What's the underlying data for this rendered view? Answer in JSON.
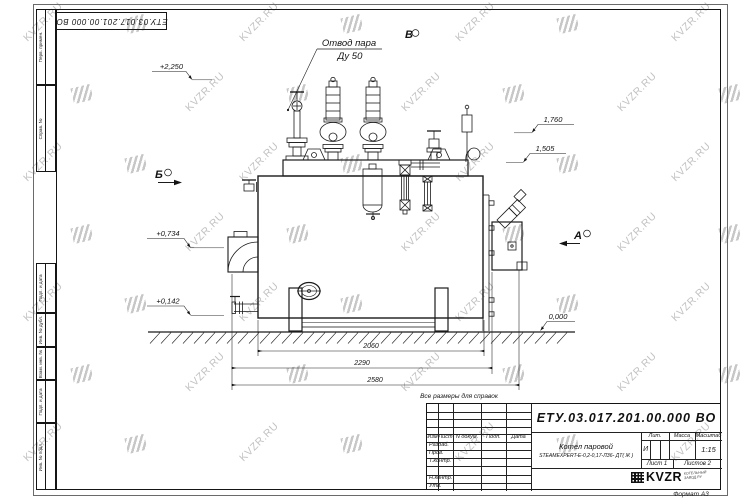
{
  "watermark": {
    "text": "KVZR.RU"
  },
  "corner_stamp": {
    "doc_number": "ЕТУ.03.017.201.00.000  ВО"
  },
  "margin": {
    "perv": "Перв. примен.",
    "sprav": "Справ. №",
    "podp1": "Подп. и дата",
    "inv_dubl": "Инв. № дубл.",
    "vzam": "Взам. инв. №",
    "podp2": "Подп. и дата",
    "inv_podl": "Инв. № подл."
  },
  "drawing": {
    "steam_outlet": {
      "line1": "Отвод пара",
      "line2": "Ду 50"
    },
    "views": {
      "top": "В",
      "right": "А",
      "left": "Б"
    },
    "elevations": {
      "e2250": "+2,250",
      "e1760": "1,760",
      "e1505": "1,505",
      "e0734": "+0,734",
      "e0142": "+0,142",
      "e0000": "0,000"
    },
    "dims": {
      "inner": "2060",
      "middle": "2290",
      "outer": "2580"
    },
    "note": "Все размеры для справок"
  },
  "title_block": {
    "doc_number": "ЕТУ.03.017.201.00.000  ВО",
    "name_line1": "Котел паровой",
    "name_line2": "STEAMEXPERT-E-0,2-0,17-ЛЗ6- ДТ( Ж )",
    "header_cols": {
      "izm": "Изм",
      "list": "Лист",
      "ndoc": "N докум.",
      "podp": "Подп.",
      "date": "Дата"
    },
    "rows": {
      "razrab": "Разраб.",
      "prov": "Пров.",
      "tkontr": "Т.контр.",
      "nkontr": "Н.контр.",
      "utv": "Утв."
    },
    "lit_label": "Лит.",
    "mass_label": "Масса",
    "scale_label": "Масштаб",
    "lit_value": "И",
    "scale_value": "1:15",
    "sheet": "Лист 1",
    "sheets": "Листов 2",
    "logo": {
      "text": "KVZR",
      "sub1": "КОТЕЛЬНЫЙ",
      "sub2": "ЗАВОД.РУ"
    },
    "format_note": "Формат А3"
  }
}
